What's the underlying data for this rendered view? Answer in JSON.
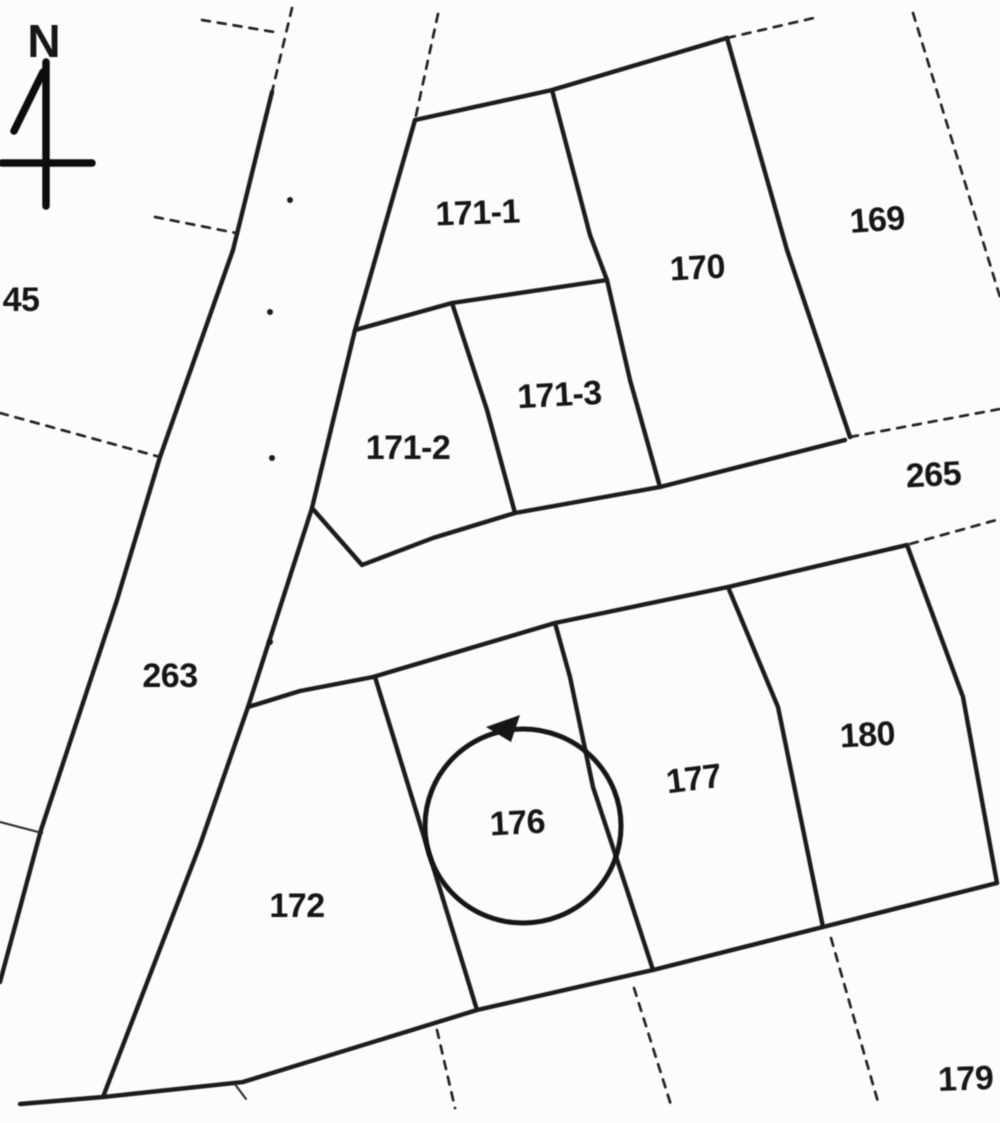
{
  "compass": {
    "label": "N"
  },
  "road_labels": {
    "r263": "263",
    "r265": "265"
  },
  "parcel_labels": {
    "p45": "45",
    "p169": "169",
    "p170": "170",
    "p171_1": "171-1",
    "p171_2": "171-2",
    "p171_3": "171-3",
    "p172": "172",
    "p176": "176",
    "p177": "177",
    "p179": "179",
    "p180": "180"
  },
  "annotation": {
    "type": "hand-drawn-circle",
    "target_parcel": "176"
  }
}
